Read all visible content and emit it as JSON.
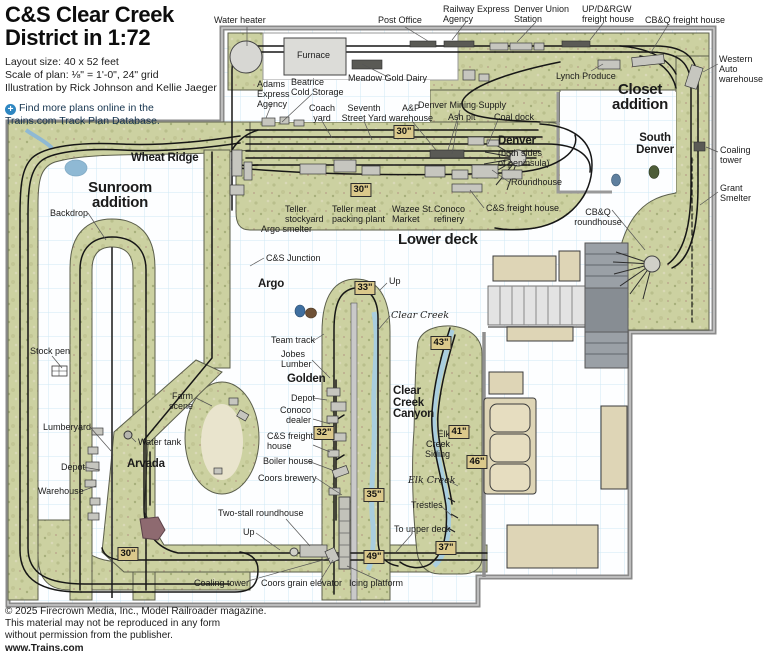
{
  "title": {
    "line1": "C&S Clear Creek",
    "line2": "District in 1:72"
  },
  "meta": [
    "Layout size: 40 x 52 feet",
    "Scale of plan: ⅛\" = 1'-0\", 24\" grid",
    "Illustration by Rick Johnson and Kellie Jaeger"
  ],
  "note": {
    "icon": "plus-circle-icon",
    "text": "Find more plans online in the\nTrains.com Track Plan Database."
  },
  "copyright": [
    "© 2025 Firecrown Media, Inc., Model Railroader magazine.",
    "This material may not be reproduced in any form",
    "without permission from the publisher.",
    "www.Trains.com"
  ],
  "colors": {
    "terrain": "#ccd1a1",
    "room_grid": "#cfe8f4",
    "wall": "#8a8a8a",
    "track": "#161616",
    "water": "#a9cede",
    "marker_bg": "#dbc98b",
    "furniture": "#ded5b6",
    "note_blue": "#2e86c1"
  },
  "map_labels": [
    {
      "id": "water-heater",
      "text": "Water heater",
      "x": 214,
      "y": 16,
      "style": "plain"
    },
    {
      "id": "post-office",
      "text": "Post Office",
      "x": 378,
      "y": 16,
      "style": "plain"
    },
    {
      "id": "railway-express",
      "text": "Railway Express\nAgency",
      "x": 443,
      "y": 5,
      "style": "plain"
    },
    {
      "id": "denver-union-station",
      "text": "Denver Union\nStation",
      "x": 514,
      "y": 5,
      "style": "plain"
    },
    {
      "id": "updrgw-freight",
      "text": "UP/D&RGW\nfreight house",
      "x": 582,
      "y": 5,
      "style": "plain"
    },
    {
      "id": "cbq-freight",
      "text": "CB&Q freight house",
      "x": 645,
      "y": 16,
      "style": "plain"
    },
    {
      "id": "western-auto",
      "text": "Western\nAuto\nwarehouse",
      "x": 719,
      "y": 55,
      "style": "plain"
    },
    {
      "id": "lynch-produce",
      "text": "Lynch Produce",
      "x": 556,
      "y": 72,
      "style": "plain"
    },
    {
      "id": "closet-addition",
      "text": "Closet\naddition",
      "x": 640,
      "y": 82,
      "style": "bold-lg",
      "align": "center"
    },
    {
      "id": "meadow-gold-dairy",
      "text": "Meadow Gold Dairy",
      "x": 348,
      "y": 74,
      "style": "plain"
    },
    {
      "id": "furnace",
      "text": "Furnace",
      "x": 297,
      "y": 51,
      "style": "plain"
    },
    {
      "id": "adams-express",
      "text": "Adams\nExpress\nAgency",
      "x": 257,
      "y": 80,
      "style": "plain"
    },
    {
      "id": "beatrice-cold-storage",
      "text": "Beatrice\nCold Storage",
      "x": 291,
      "y": 78,
      "style": "plain"
    },
    {
      "id": "coach-yard",
      "text": "Coach\nyard",
      "x": 322,
      "y": 104,
      "style": "plain",
      "align": "center"
    },
    {
      "id": "seventh-street-yard",
      "text": "Seventh\nStreet Yard",
      "x": 364,
      "y": 104,
      "style": "plain",
      "align": "center"
    },
    {
      "id": "ap-warehouse",
      "text": "A&P\nwarehouse",
      "x": 411,
      "y": 104,
      "style": "plain",
      "align": "center"
    },
    {
      "id": "denver-mining-supply",
      "text": "Denver Mining Supply",
      "x": 418,
      "y": 101,
      "style": "plain"
    },
    {
      "id": "ash-pit",
      "text": "Ash pit",
      "x": 448,
      "y": 113,
      "style": "plain"
    },
    {
      "id": "coal-dock",
      "text": "Coal dock",
      "x": 494,
      "y": 113,
      "style": "plain"
    },
    {
      "id": "m30a",
      "text": "30\"",
      "x": 404,
      "y": 125,
      "style": "marker"
    },
    {
      "id": "denver",
      "text": "Denver",
      "x": 498,
      "y": 136,
      "style": "bold-sm"
    },
    {
      "id": "denver-sub",
      "text": "(both sides\nof peninsula)",
      "x": 498,
      "y": 149,
      "style": "plain"
    },
    {
      "id": "south-denver",
      "text": "South\nDenver",
      "x": 655,
      "y": 133,
      "style": "bold-sm",
      "align": "center"
    },
    {
      "id": "coaling-tower-right",
      "text": "Coaling\ntower",
      "x": 720,
      "y": 146,
      "style": "plain"
    },
    {
      "id": "grant-smelter",
      "text": "Grant\nSmelter",
      "x": 720,
      "y": 184,
      "style": "plain"
    },
    {
      "id": "roundhouse",
      "text": "Roundhouse",
      "x": 511,
      "y": 178,
      "style": "plain"
    },
    {
      "id": "m30b",
      "text": "30\"",
      "x": 361,
      "y": 183,
      "style": "marker"
    },
    {
      "id": "cs-freight-upper",
      "text": "C&S freight house",
      "x": 486,
      "y": 204,
      "style": "plain"
    },
    {
      "id": "cbq-roundhouse",
      "text": "CB&Q\nroundhouse",
      "x": 598,
      "y": 208,
      "style": "plain",
      "align": "center"
    },
    {
      "id": "wheat-ridge",
      "text": "Wheat Ridge",
      "x": 131,
      "y": 153,
      "style": "bold-sm"
    },
    {
      "id": "teller-stockyard",
      "text": "Teller\nstockyard",
      "x": 285,
      "y": 205,
      "style": "plain"
    },
    {
      "id": "teller-meat",
      "text": "Teller meat\npacking plant",
      "x": 332,
      "y": 205,
      "style": "plain"
    },
    {
      "id": "wazee-market",
      "text": "Wazee St.\nMarket",
      "x": 392,
      "y": 205,
      "style": "plain"
    },
    {
      "id": "conoco-refinery",
      "text": "Conoco\nrefinery",
      "x": 434,
      "y": 205,
      "style": "plain"
    },
    {
      "id": "argo-smelter",
      "text": "Argo smelter",
      "x": 261,
      "y": 225,
      "style": "plain"
    },
    {
      "id": "lower-deck",
      "text": "Lower deck",
      "x": 398,
      "y": 232,
      "style": "bold-lg"
    },
    {
      "id": "sunroom-addition",
      "text": "Sunroom\naddition",
      "x": 120,
      "y": 180,
      "style": "bold-lg",
      "align": "center"
    },
    {
      "id": "backdrop",
      "text": "Backdrop",
      "x": 50,
      "y": 209,
      "style": "plain"
    },
    {
      "id": "stock-pen",
      "text": "Stock pen",
      "x": 30,
      "y": 347,
      "style": "plain"
    },
    {
      "id": "cs-junction",
      "text": "C&S Junction",
      "x": 266,
      "y": 254,
      "style": "plain"
    },
    {
      "id": "argo",
      "text": "Argo",
      "x": 258,
      "y": 279,
      "style": "bold-sm"
    },
    {
      "id": "m33",
      "text": "33\"",
      "x": 365,
      "y": 281,
      "style": "marker"
    },
    {
      "id": "up-argo",
      "text": "Up",
      "x": 389,
      "y": 277,
      "style": "plain"
    },
    {
      "id": "clear-creek",
      "text": "Clear Creek",
      "x": 391,
      "y": 311,
      "style": "italic"
    },
    {
      "id": "team-track",
      "text": "Team track",
      "x": 271,
      "y": 336,
      "style": "plain"
    },
    {
      "id": "jobes-lumber",
      "text": "Jobes\nLumber",
      "x": 281,
      "y": 350,
      "style": "plain"
    },
    {
      "id": "golden",
      "text": "Golden",
      "x": 287,
      "y": 374,
      "style": "bold-sm"
    },
    {
      "id": "m43",
      "text": "43\"",
      "x": 441,
      "y": 336,
      "style": "marker"
    },
    {
      "id": "depot-golden",
      "text": "Depot",
      "x": 291,
      "y": 394,
      "style": "plain"
    },
    {
      "id": "conoco-dealer",
      "text": "Conoco\ndealer",
      "x": 311,
      "y": 406,
      "style": "plain",
      "align": "right"
    },
    {
      "id": "m32",
      "text": "32\"",
      "x": 324,
      "y": 426,
      "style": "marker"
    },
    {
      "id": "cs-freight-golden",
      "text": "C&S freight\nhouse",
      "x": 267,
      "y": 432,
      "style": "plain"
    },
    {
      "id": "boiler-house",
      "text": "Boiler house",
      "x": 263,
      "y": 457,
      "style": "plain"
    },
    {
      "id": "coors-brewery",
      "text": "Coors brewery",
      "x": 258,
      "y": 474,
      "style": "plain"
    },
    {
      "id": "clear-creek-canyon",
      "text": "Clear\nCreek\nCanyon",
      "x": 393,
      "y": 386,
      "style": "bold-sm"
    },
    {
      "id": "elk-creek-siding",
      "text": "Elk\nCreek\nSiding",
      "x": 450,
      "y": 430,
      "style": "plain",
      "align": "right"
    },
    {
      "id": "m41",
      "text": "41\"",
      "x": 459,
      "y": 425,
      "style": "marker"
    },
    {
      "id": "m46",
      "text": "46\"",
      "x": 477,
      "y": 455,
      "style": "marker"
    },
    {
      "id": "elk-creek",
      "text": "Elk Creek",
      "x": 408,
      "y": 476,
      "style": "italic"
    },
    {
      "id": "trestles",
      "text": "Trestles",
      "x": 411,
      "y": 501,
      "style": "plain"
    },
    {
      "id": "m35",
      "text": "35\"",
      "x": 374,
      "y": 488,
      "style": "marker"
    },
    {
      "id": "farm-scene",
      "text": "Farm\nscene",
      "x": 193,
      "y": 392,
      "style": "plain",
      "align": "right"
    },
    {
      "id": "lumberyard",
      "text": "Lumberyard",
      "x": 43,
      "y": 423,
      "style": "plain"
    },
    {
      "id": "water-tank",
      "text": "Water tank",
      "x": 138,
      "y": 438,
      "style": "plain"
    },
    {
      "id": "arvada",
      "text": "Arvada",
      "x": 127,
      "y": 459,
      "style": "bold-sm"
    },
    {
      "id": "depot-arvada",
      "text": "Depot",
      "x": 61,
      "y": 463,
      "style": "plain"
    },
    {
      "id": "warehouse",
      "text": "Warehouse",
      "x": 38,
      "y": 487,
      "style": "plain"
    },
    {
      "id": "two-stall-roundhouse",
      "text": "Two-stall roundhouse",
      "x": 218,
      "y": 509,
      "style": "plain"
    },
    {
      "id": "up-bottom",
      "text": "Up",
      "x": 243,
      "y": 528,
      "style": "plain"
    },
    {
      "id": "to-upper-deck",
      "text": "To upper deck",
      "x": 394,
      "y": 525,
      "style": "plain"
    },
    {
      "id": "m49",
      "text": "49\"",
      "x": 374,
      "y": 550,
      "style": "marker"
    },
    {
      "id": "m37",
      "text": "37\"",
      "x": 446,
      "y": 541,
      "style": "marker"
    },
    {
      "id": "m30c",
      "text": "30\"",
      "x": 128,
      "y": 547,
      "style": "marker"
    },
    {
      "id": "coaling-tower-bottom",
      "text": "Coaling tower",
      "x": 194,
      "y": 579,
      "style": "plain"
    },
    {
      "id": "coors-grain-elevator",
      "text": "Coors grain elevator",
      "x": 261,
      "y": 579,
      "style": "plain"
    },
    {
      "id": "icing-platform",
      "text": "Icing platform",
      "x": 349,
      "y": 579,
      "style": "plain"
    }
  ]
}
